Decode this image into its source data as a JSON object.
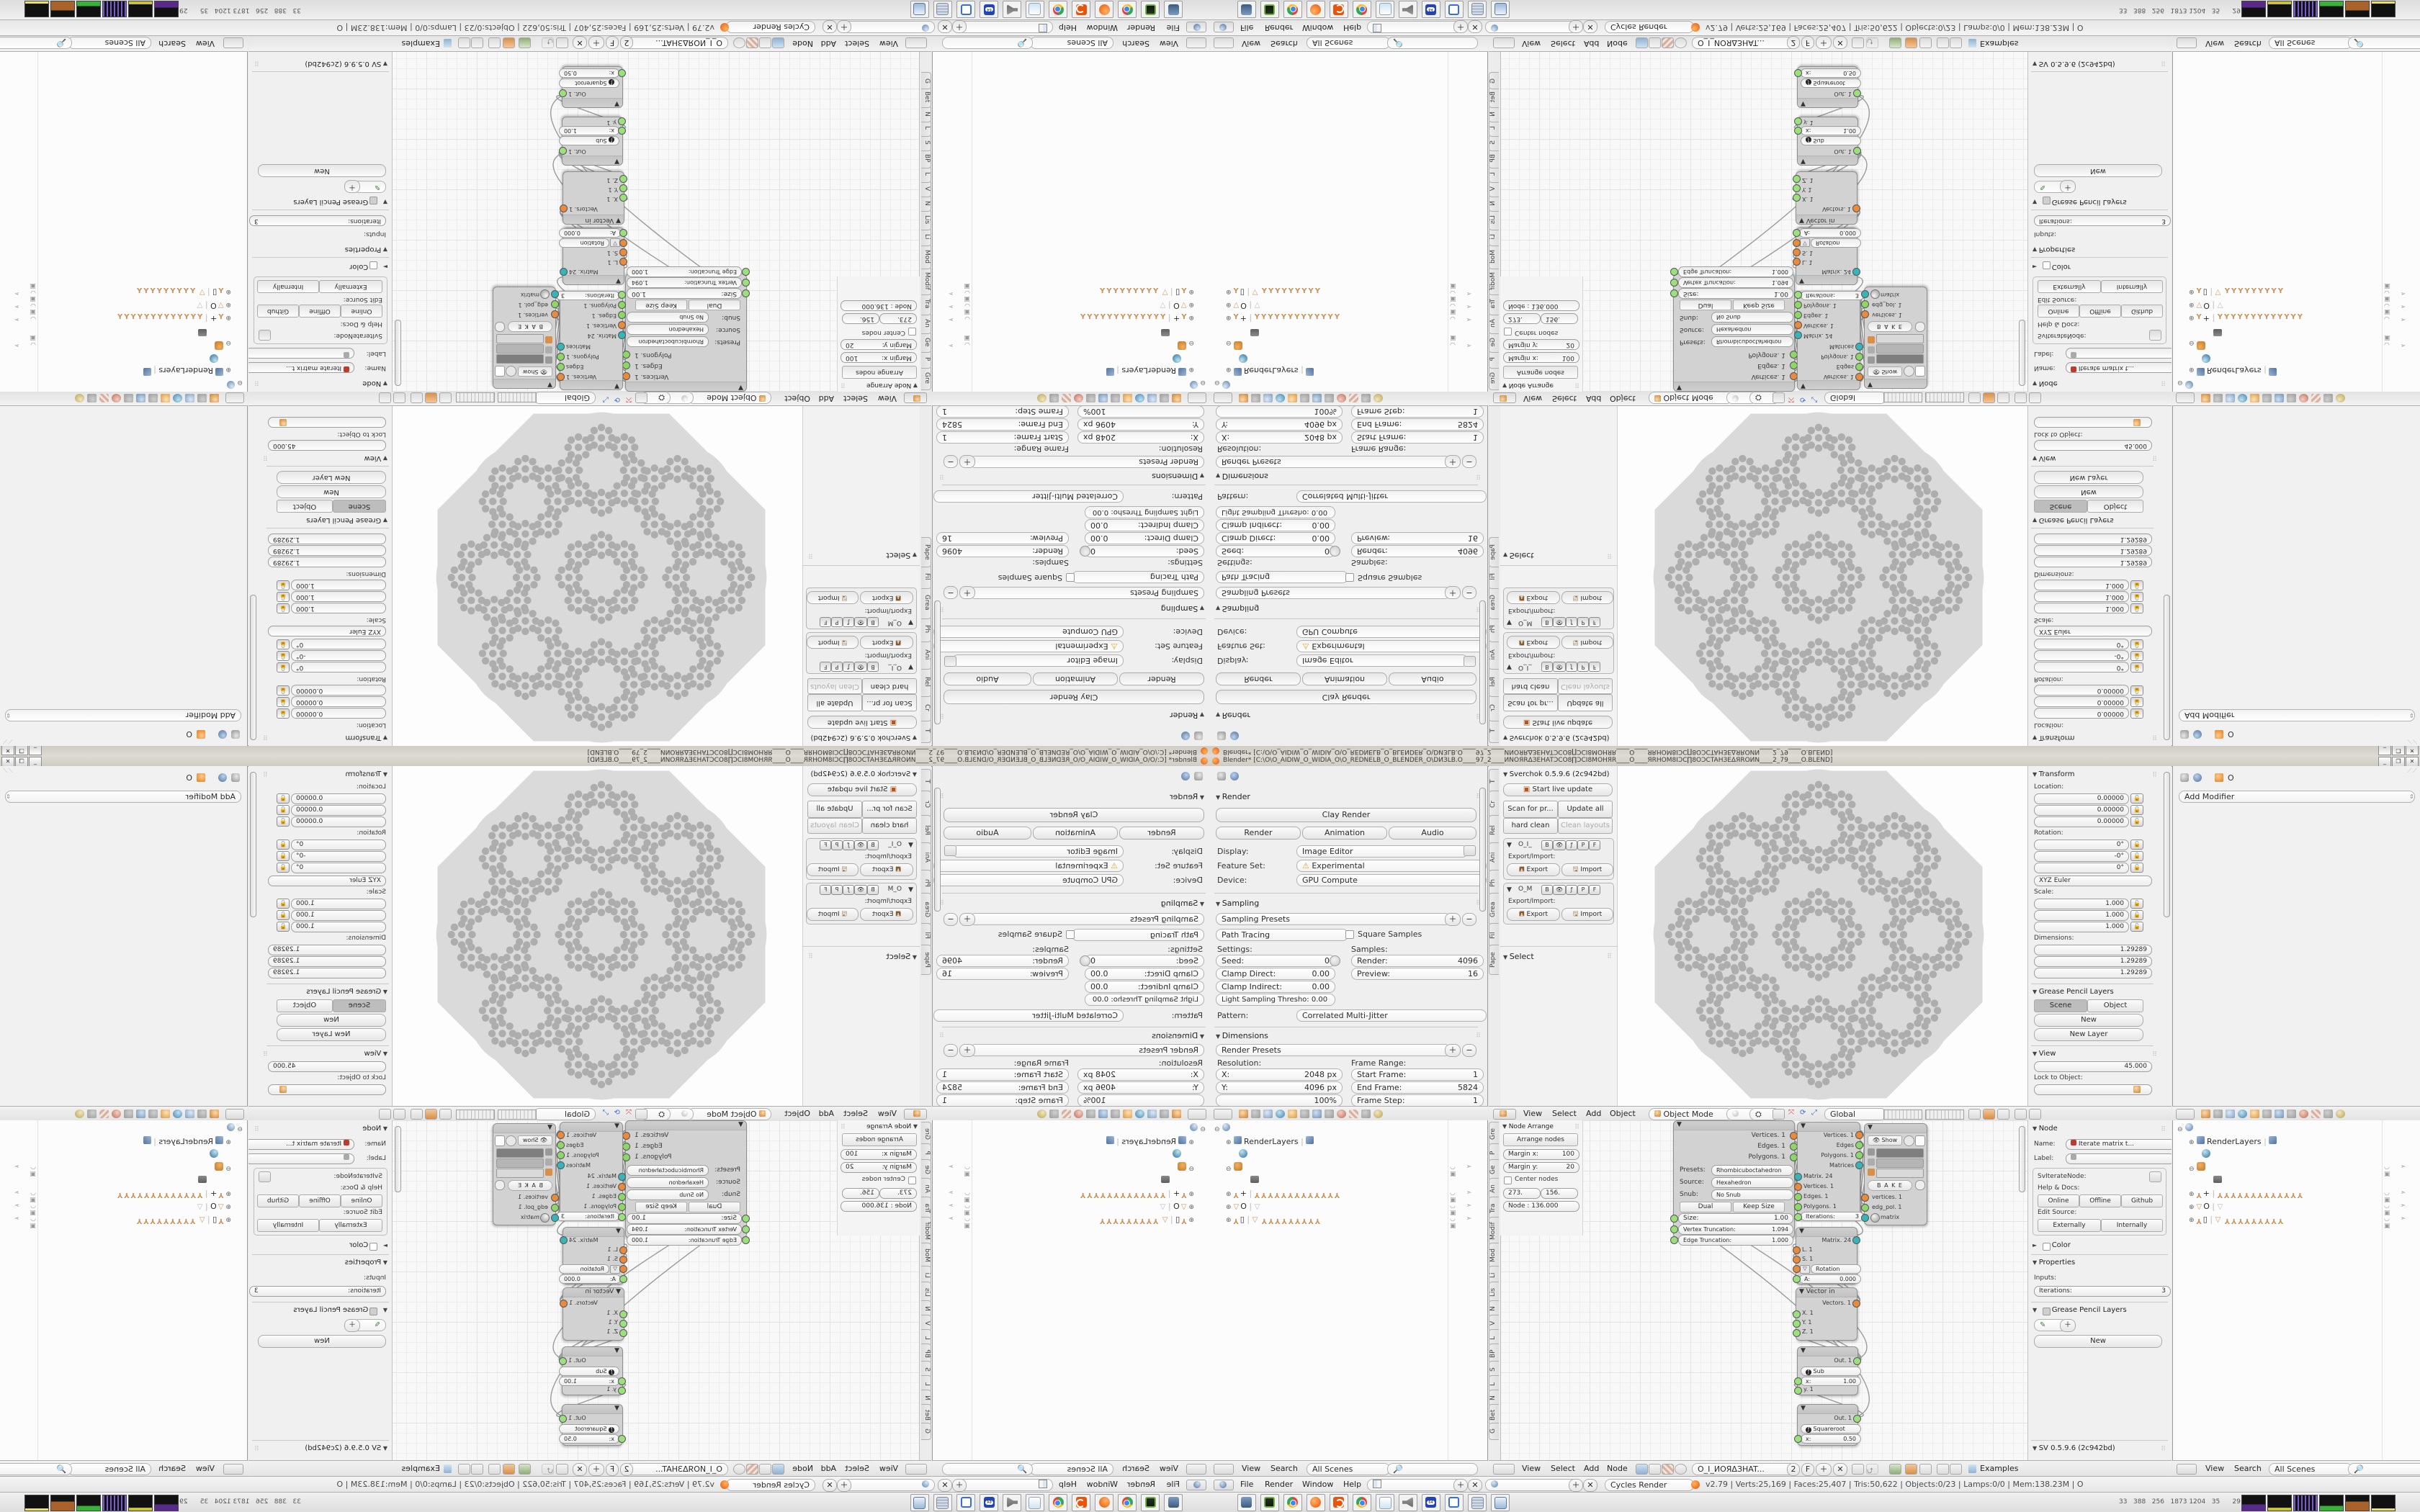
{
  "window": {
    "title": "Blender* [C:\\O\\O_AIDIW_O_WIDIA_O\\O_REDNELB_O_BLENDER_O\\DИЗLB.O____97_2____ИNOЯRΔЗEHATƆCO8∏ƆCI8MOHЯR____O____ЯRHOM8IƆC∏8OƆCTAHЗEΔЯROИN____2_79____O.BLEND]",
    "minimize": "_",
    "restore": "❐",
    "close": "✕"
  },
  "props": {
    "render_title": "Render",
    "clay": "Clay Render",
    "render_btn": "Render",
    "anim_btn": "Animation",
    "audio_btn": "Audio",
    "display_l": "Display:",
    "display_v": "Image Editor",
    "feature_l": "Feature Set:",
    "feature_v": "Experimental",
    "device_l": "Device:",
    "device_v": "GPU Compute",
    "sampling_title": "Sampling",
    "sampling_presets": "Sampling Presets",
    "integrator": "Path Tracing",
    "square": "Square Samples",
    "settings_l": "Settings:",
    "samples_l": "Samples:",
    "seed_l": "Seed:",
    "seed_v": "0",
    "clampd_l": "Clamp Direct:",
    "clampd_v": "0.00",
    "clampi_l": "Clamp Indirect:",
    "clampi_v": "0.00",
    "light_l": "Light Sampling Thresho:",
    "light_v": "0.00",
    "rsamp_l": "Render:",
    "rsamp_v": "4096",
    "psamp_l": "Preview:",
    "psamp_v": "16",
    "pattern_l": "Pattern:",
    "pattern_v": "Correlated Multi-Jitter",
    "dim_title": "Dimensions",
    "render_presets": "Render Presets",
    "res_l": "Resolution:",
    "fr_l": "Frame Range:",
    "resx_l": "X:",
    "resx_v": "2048 px",
    "resy_l": "Y:",
    "resy_v": "4096 px",
    "pct": "100%",
    "start_l": "Start Frame:",
    "start_v": "1",
    "end_l": "End Frame:",
    "end_v": "5824",
    "step_l": "Frame Step:",
    "step_v": "1",
    "aspect_l": "Aspect Ratio:",
    "rate_l": "Frame Rate:"
  },
  "shelf3d": {
    "tabs": [
      "T",
      "Cr",
      "Rel",
      "Ani",
      "Ph",
      "Grea",
      "Fil",
      "Pape"
    ],
    "title": "Sverchok 0.5.9.6 (2c942bd)",
    "start": "Start live update",
    "scan": "Scan for pr...",
    "update": "Update all",
    "hard": "hard clean",
    "clean": "Clean layouts",
    "tree1": "O_I_",
    "tree2": "O_M",
    "b": "B",
    "p": "P",
    "f": "F",
    "exim": "Export/Import:",
    "export": "Export",
    "import": "Import",
    "select_title": "Select"
  },
  "view3d": {
    "menus": [
      "View",
      "Select",
      "Add",
      "Object"
    ],
    "mode": "Object Mode",
    "orientation": "Global"
  },
  "npanel": {
    "transform": "Transform",
    "loc_l": "Location:",
    "loc": [
      "0.00000",
      "0.00000",
      "0.00000"
    ],
    "rot_l": "Rotation:",
    "rot": [
      "0°",
      "-0°",
      "0°"
    ],
    "euler": "XYZ Euler",
    "scale_l": "Scale:",
    "scale": [
      "1.000",
      "1.000",
      "1.000"
    ],
    "dim_l": "Dimensions:",
    "dim": [
      "1.29289",
      "1.29289",
      "1.29289"
    ],
    "gp_title": "Grease Pencil Layers",
    "gp_scene": "Scene",
    "gp_object": "Object",
    "gp_new": "New",
    "gp_new_layer": "New Layer",
    "view_title": "View",
    "lens": "45.000",
    "lock_l": "Lock to Object:"
  },
  "props2": {
    "object": "O",
    "add_modifier": "Add Modifier"
  },
  "outliner": {
    "menus": [
      "View",
      "Search"
    ],
    "scenes": "All Scenes",
    "renderlayers": "RenderLayers",
    "name_plus": "+",
    "name_o": "O",
    "name_box": "▯",
    "bones_a": 13,
    "bones_b": 9
  },
  "nodeed": {
    "tabs": [
      "Gre",
      "P",
      "Ge",
      "An",
      "Tra",
      "Modif",
      "Mod",
      "Li",
      "Lis",
      "N",
      "V",
      "L",
      "BP",
      "S",
      "L",
      "N",
      "Bet",
      "G"
    ],
    "arrange": {
      "title": "Node Arrange",
      "btn": "Arrange nodes",
      "mx_l": "Margin x:",
      "mx_v": "100",
      "my_l": "Margin y:",
      "my_v": "20",
      "center": "Center nodes",
      "v1": "273.",
      "v2": "156.",
      "node": "Node : 136.000"
    },
    "menus": [
      "View",
      "Select",
      "Add",
      "Node"
    ],
    "tree": "O_I_ИOЯΔЗHAT...",
    "users": "2",
    "fake": "F",
    "examples": "Examples",
    "rs": {
      "o1": "Vertices. 1",
      "o2": "Edges. 1",
      "o3": "Polygons. 1",
      "presets_l": "Presets:",
      "presets": "Rhombicuboctahedron",
      "source_l": "Source:",
      "source": "Hexahedron",
      "snub_l": "Snub:",
      "snub": "No Snub",
      "dual": "Dual",
      "keep": "Keep Size",
      "size_l": "Size:",
      "size_v": "1.00",
      "vt_l": "Vertex Truncation:",
      "vt_v": "1.094",
      "et_l": "Edge Truncation:",
      "et_v": "1.000"
    },
    "it": {
      "o1": "Vertices. 1",
      "o2": "Edges",
      "o3": "Polygons. 1",
      "o4": "Matrices",
      "i1": "Matrix. 24",
      "i2": "Vertices. 1",
      "i3": "Edges. 1",
      "i4": "Polygons. 1",
      "iter_l": "Iterations:",
      "iter_v": "3"
    },
    "vd": {
      "show": "Show",
      "bake": "B A K E",
      "i1": "vertices. 1",
      "i2": "edg_pol. 1",
      "i3": "matrix"
    },
    "mi": {
      "o1": "Matrix. 24",
      "i1": "L. 1",
      "i2": "S. 1",
      "rot": "Rotation",
      "a_l": "A:",
      "a_v": "0.000"
    },
    "vi": {
      "title": "Vector in",
      "o1": "Vectors. 1",
      "i1": "X. 1",
      "i2": "Y. 1",
      "i3": "Z. 1"
    },
    "ms": {
      "o1": "Out. 1",
      "op": "Sub",
      "x_l": "x:",
      "x_v": "1.00",
      "y": "y. 1"
    },
    "mq": {
      "o1": "Out. 1",
      "op": "Squareroot",
      "x_l": "x:",
      "x_v": "0.50"
    },
    "np": {
      "node": "Node",
      "name_l": "Name:",
      "name": "Iterate matrix t...",
      "label_l": "Label:",
      "cls": "SvIterateNode:",
      "help": "Help & Docs:",
      "online": "Online",
      "offline": "Offline",
      "github": "Github",
      "edit": "Edit Source:",
      "ext": "Externally",
      "int": "Internally",
      "color": "Color",
      "props": "Properties",
      "inputs": "Inputs:",
      "iter_l": "Iterations:",
      "iter_v": "3",
      "gp": "Grease Pencil Layers",
      "new": "New",
      "sv": "SV 0.5.9.6 (2c942bd)"
    }
  },
  "info": {
    "menus": [
      "File",
      "Render",
      "Window",
      "Help"
    ],
    "engine": "Cycles Render",
    "stats": "v2.79 | Verts:25,169 | Faces:25,407 | Tris:50,622 | Objects:0/23 | Lamps:0/0 | Mem:138.23M | O"
  },
  "taskbar": {
    "tray": "33   388   256   1873 1204   35      29"
  }
}
